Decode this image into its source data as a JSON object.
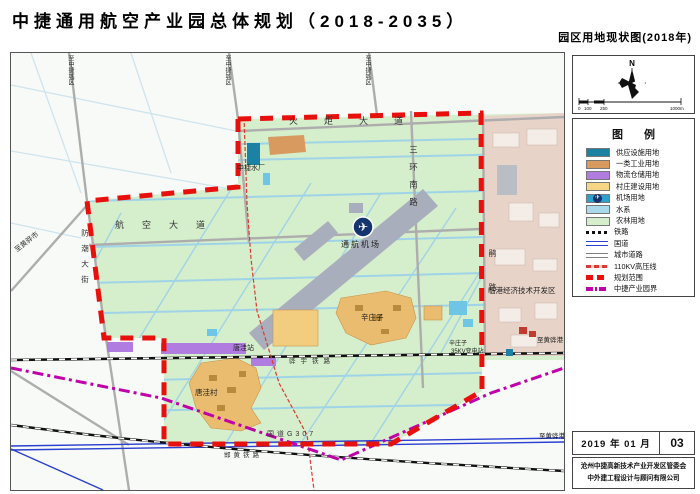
{
  "title": "中捷通用航空产业园总体规划（2018-2035）",
  "subtitle": "园区用地现状图(2018年)",
  "compass": {
    "north_label": "N",
    "scale_ticks": [
      "0",
      "100",
      "250"
    ],
    "scale_end": "1000m"
  },
  "legend": {
    "title": "图 例",
    "area_items": [
      {
        "label": "供应设施用地",
        "color": "#1b82a3"
      },
      {
        "label": "一类工业用地",
        "color": "#d99a5f"
      },
      {
        "label": "物流仓储用地",
        "color": "#b07ce0"
      },
      {
        "label": "村庄建设用地",
        "color": "#f6d584"
      },
      {
        "label": "机场用地",
        "color": "#2f9fce",
        "icon": "✈"
      },
      {
        "label": "水系",
        "color": "#a9d9ea"
      },
      {
        "label": "农林用地",
        "color": "#d5eecb"
      }
    ],
    "line_items": [
      {
        "label": "铁路",
        "style": "railway"
      },
      {
        "label": "国道",
        "style": "national-road",
        "color": "#2b3fd0"
      },
      {
        "label": "城市道路",
        "style": "city-road",
        "color": "#808080"
      },
      {
        "label": "110KV高压线",
        "style": "powerline",
        "color": "#e0392f"
      },
      {
        "label": "规划范围",
        "style": "plan-boundary",
        "color": "#e8100c"
      },
      {
        "label": "中捷产业园界",
        "style": "park-boundary",
        "color": "#c000a8"
      }
    ]
  },
  "map_labels": {
    "to_city_1": "至中捷城区",
    "to_city_2": "至中捷城区",
    "to_city_3": "至中捷城区",
    "huoju_dadao": "火炬大道",
    "hangkong_dadao": "航空大道",
    "sanhuan_nanlu": "三环南路",
    "fangchao_dajie": "防潮大街",
    "juan_lu": "鹃路",
    "shuichang": "中捷水厂",
    "jichang": "通航机场",
    "airport_icon": "✈",
    "tangwa_zhan": "唐洼站",
    "tangwa_cun": "唐洼村",
    "xinzhuangzi": "辛庄子",
    "substation_name": "辛庄子",
    "substation": "35KV变电站",
    "huayu_tielu": "骅宇铁路",
    "g307": "国道G307",
    "hanhuang_tielu": "邯黄铁路",
    "lingang_zone": "临港经济技术开发区",
    "to_huanghua_city": "至黄骅市",
    "to_huanghua_port_1": "至黄骅港",
    "to_huanghua_port_2": "至黄骅港"
  },
  "titleblock": {
    "date": "2019 年 01 月",
    "sheet_no": "03",
    "org_line1": "沧州中捷高新技术产业开发区管委会",
    "org_line2": "中外建工程设计与顾问有限公司"
  },
  "colors": {
    "farmland_green": "#d5eecb",
    "dev_zone_pink": "#e7d3c8",
    "water_blue": "#9fd4e8",
    "runway_gray": "#a9aebc",
    "plan_boundary_red": "#e8100c",
    "park_boundary_magenta": "#c000a8"
  }
}
